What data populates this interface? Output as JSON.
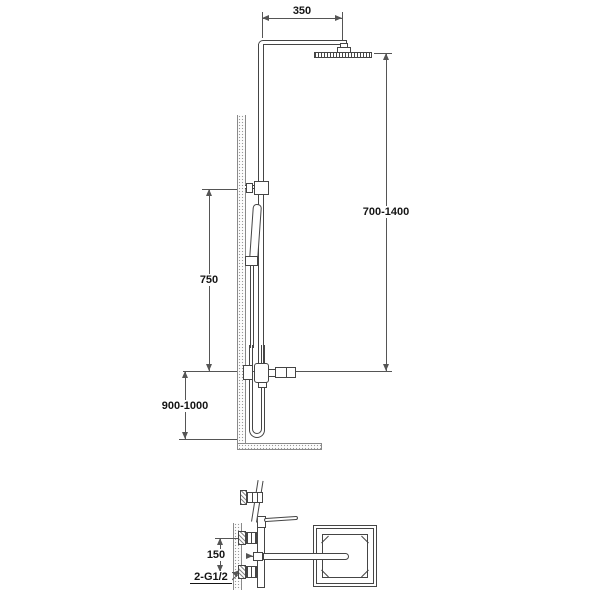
{
  "diagram": {
    "labels": {
      "arm_width": "350",
      "head_height_range": "700-1400",
      "bar_height": "750",
      "mixer_height_range": "900-1000",
      "inlet_spacing": "150",
      "inlet_thread": "2-G1/2"
    },
    "colors": {
      "line": "#454545",
      "dim": "#555555",
      "text": "#151515",
      "wall": "#9a9a9a"
    }
  }
}
